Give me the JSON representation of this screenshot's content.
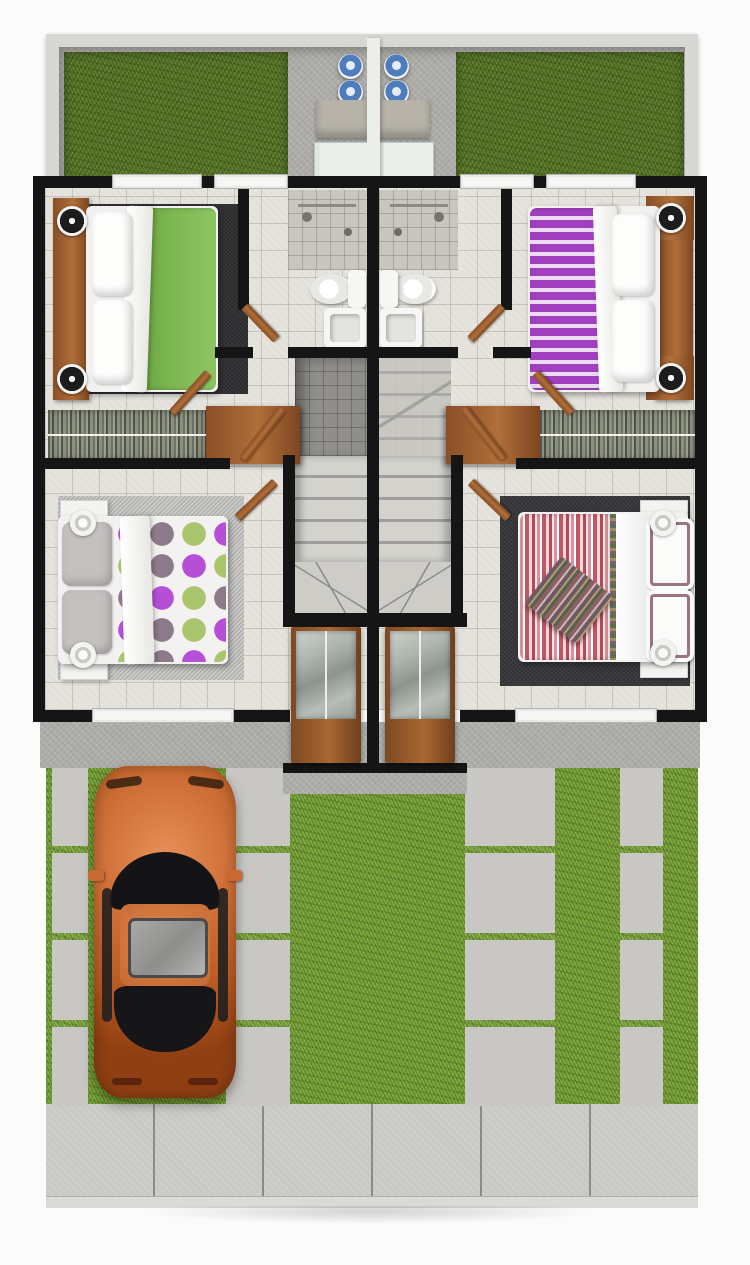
{
  "meta": {
    "title": "Top-down 3D rendered floor plan of a mirrored duplex house",
    "type": "architectural-floor-plan-render",
    "view": "top-down",
    "text_on_screen": "none"
  },
  "palette": {
    "wall": "#151515",
    "tile": "#e3e1da",
    "concrete": "#adaca8",
    "grass-back": "#59762a",
    "grass-front": "#7aa43a",
    "wood": "#b06f3a",
    "sill": "#f6f6f4",
    "steps": "#d3d2cd",
    "tank-blue": "#4f7cbc",
    "rug-dark": "#303033",
    "rug-light": "#c9c9c7",
    "duvet-green": "#7cb751",
    "duvet-purple": "#a13fc0",
    "dot-purple": "#b44fd6",
    "dot-mauve": "#8d7a8b",
    "dot-green": "#a9c56d",
    "stripe-red": "#c25663",
    "car": "#cf7038",
    "fence": "#eceeea"
  },
  "scene": {
    "property": {
      "layout": "two identical mirrored units divided by a central party wall",
      "sections": [
        "back patio with lawns and laundry area",
        "floor plan with four bedrooms, two bathrooms, closets and twin staircases",
        "front yard with paver driveway strips and parked car",
        "street sidewalk"
      ]
    },
    "backyard": {
      "left_unit_items": [
        "lawn patch",
        "2 gas tanks",
        "laundry counter",
        "washing machine"
      ],
      "right_unit_items": [
        "2 gas tanks",
        "laundry counter",
        "washing machine",
        "lawn patch"
      ],
      "divider": "white party fence"
    },
    "bedrooms": [
      {
        "id": "top-left",
        "bedding": "green duvet with white sheets and two white pillows",
        "rug": "dark charcoal",
        "furniture": [
          "wood headboard wall",
          "two wood nightstands",
          "two speaker-style round lamps"
        ]
      },
      {
        "id": "top-right",
        "bedding": "purple-and-white striped duvet with white sheets and two white pillows",
        "rug": "none",
        "furniture": [
          "wood headboard wall",
          "two wood nightstands",
          "two speaker-style round lamps"
        ]
      },
      {
        "id": "bottom-left",
        "bedding": "polka-dot duvet (purple, mauve, green dots) with gray pillows",
        "rug": "light gray",
        "furniture": [
          "two white nightstands",
          "two round white lamps"
        ]
      },
      {
        "id": "bottom-right",
        "bedding": "red-pink striped duvet, white sheet, striped pillows, folded striped throw",
        "rug": "dark charcoal",
        "furniture": [
          "two white nightstands",
          "two round white lamps"
        ]
      }
    ],
    "bathrooms": {
      "count": 2,
      "each": [
        "walk-in shower with fixtures",
        "toilet with tank",
        "square basin sink"
      ]
    },
    "closets": {
      "count": 2,
      "each": [
        "hanging clothes rail",
        "wood wardrobe dresser"
      ]
    },
    "stairs": {
      "count": 2,
      "description": "mirrored staircases descending from upper landing to glazed entry, wood handrails, winder steps at bottom"
    },
    "entry": {
      "glazed_doors": 2,
      "frame": "wood",
      "position": "center front, protruding"
    },
    "front_yard": {
      "left": "orange sedan parked nose-in on twin concrete paver strips over lawn",
      "right": "wide paver driveway strip and narrow paver walkway over lawn"
    },
    "car": {
      "type": "sedan",
      "color": "orange",
      "features": [
        "sunroof",
        "black windshield",
        "rear window",
        "side mirrors"
      ],
      "orientation": "facing the house"
    },
    "sidewalk": {
      "slabs": 6,
      "position": "bottom, full width"
    }
  }
}
